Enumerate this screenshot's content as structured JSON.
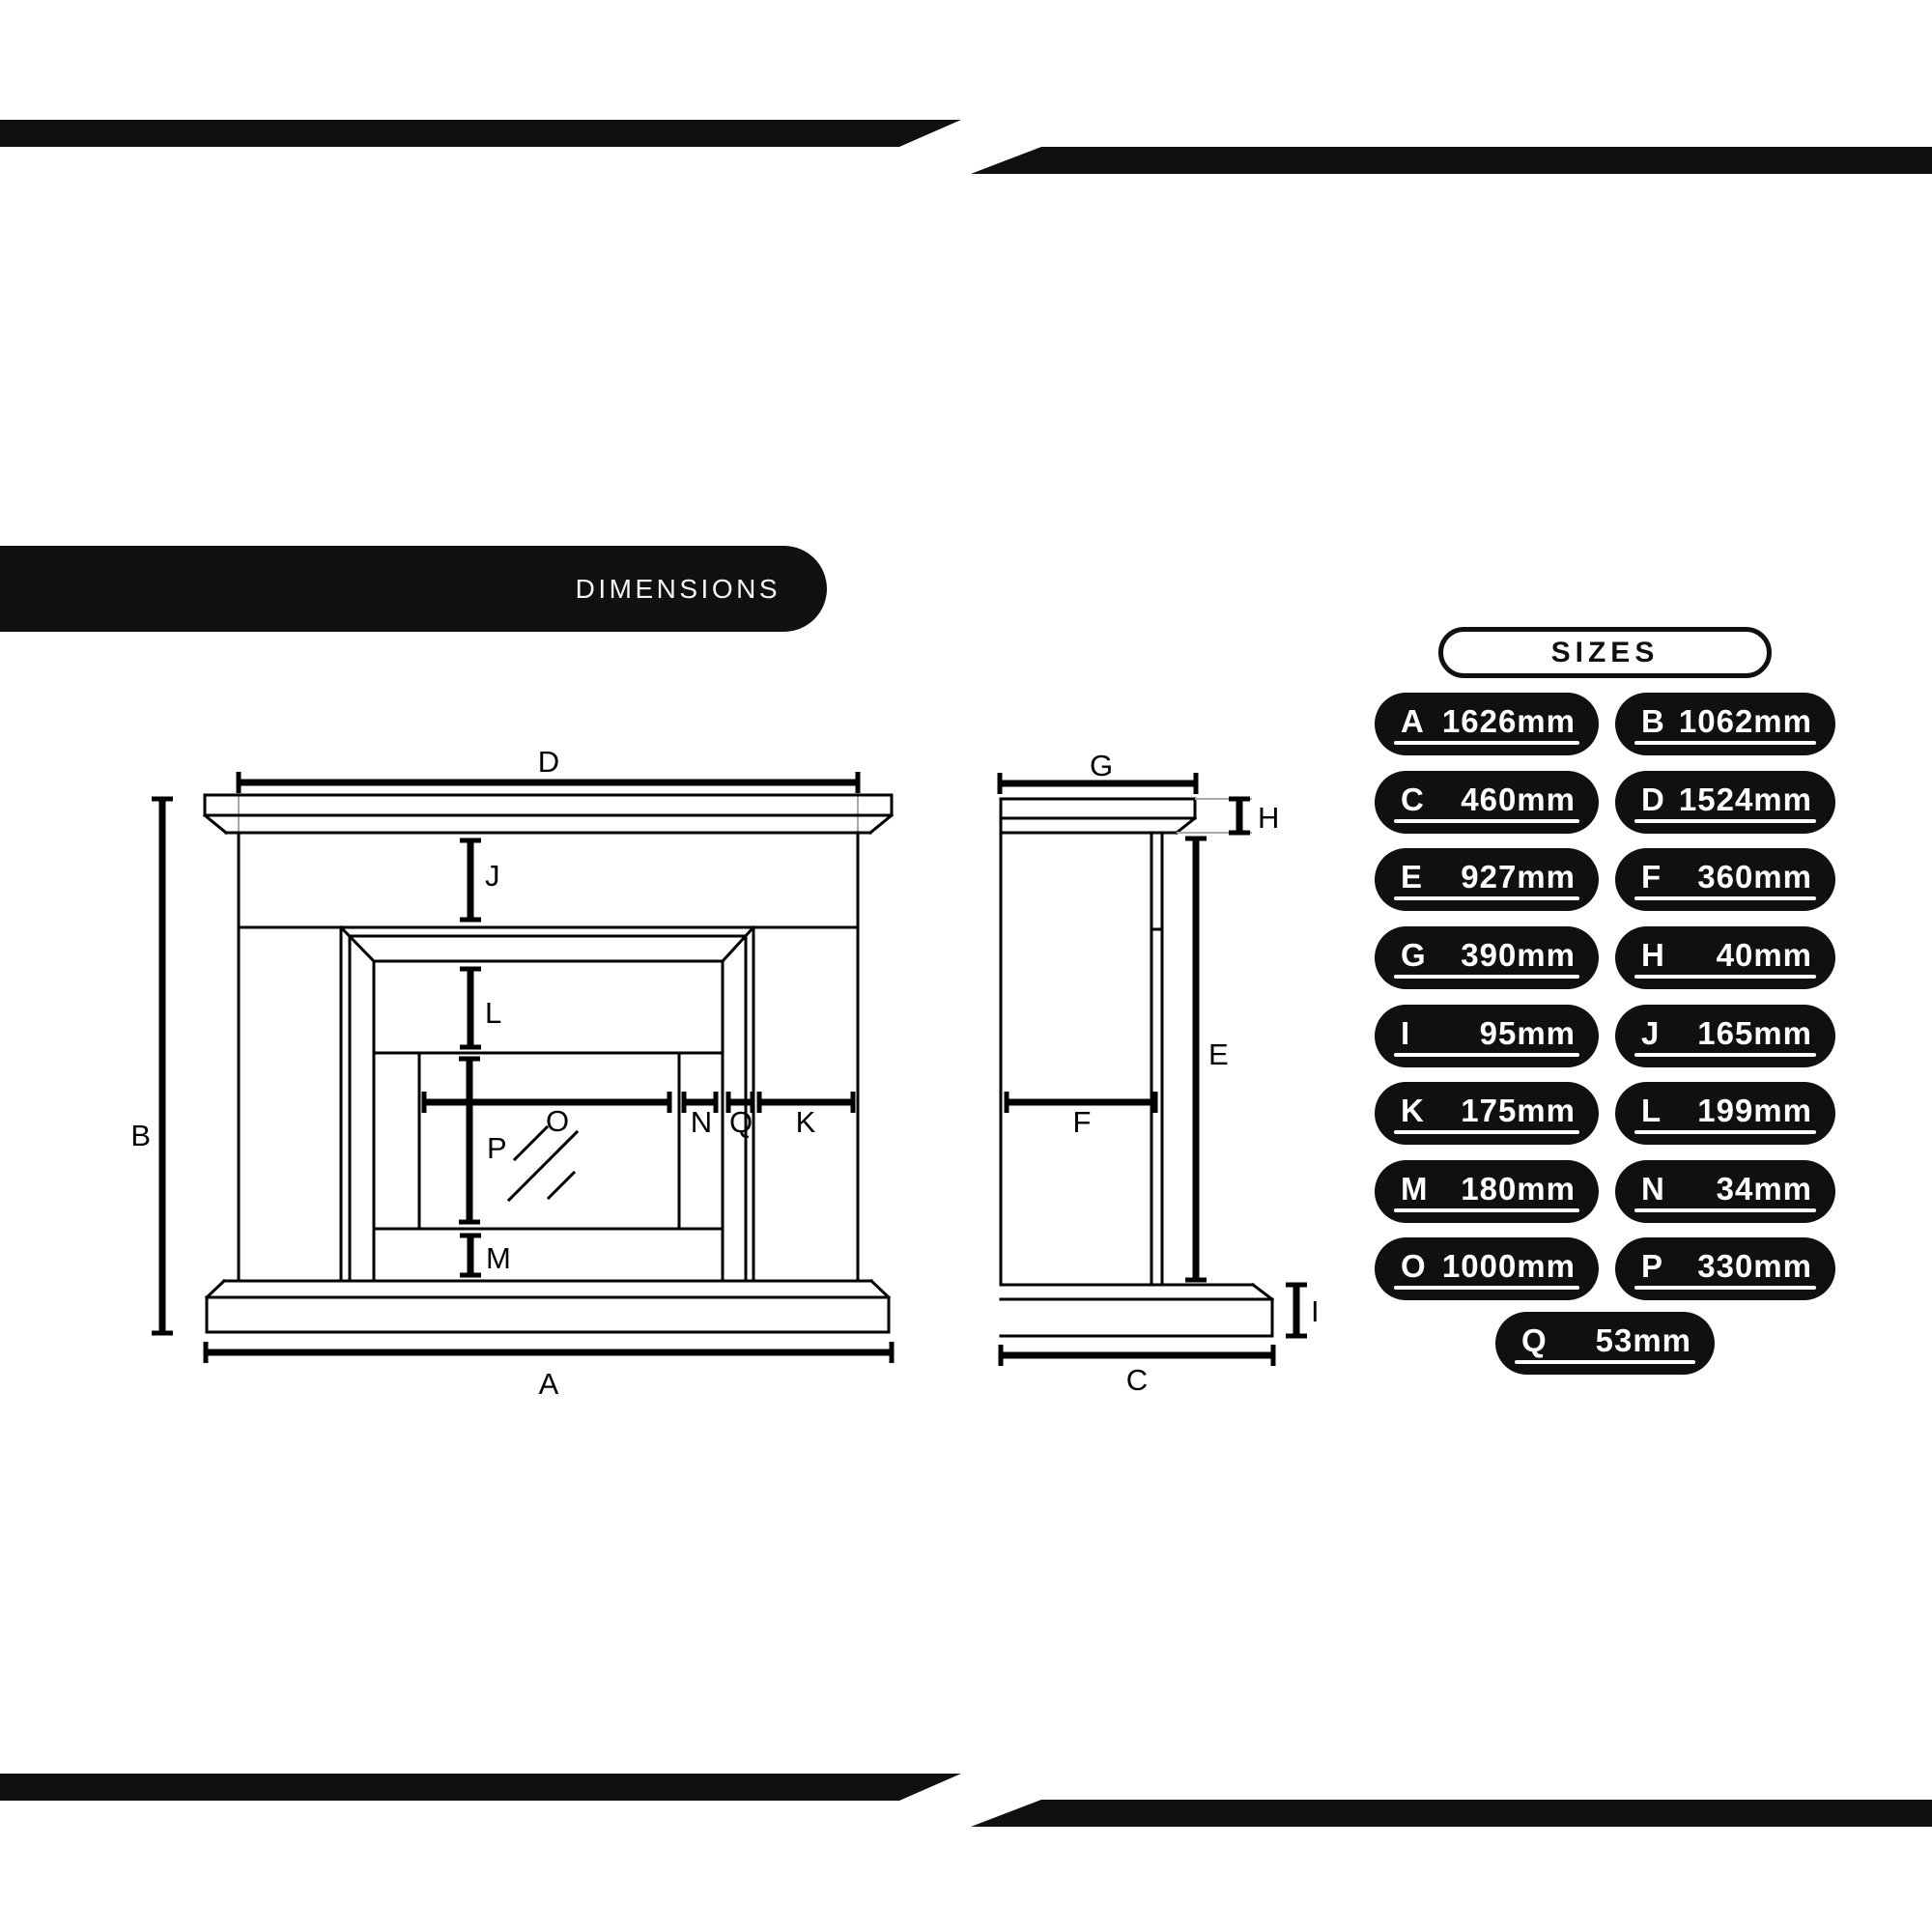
{
  "page": {
    "background": "#ffffff",
    "ink": "#101010"
  },
  "banner": {
    "label": "DIMENSIONS"
  },
  "sizes": {
    "title": "SIZES",
    "units": "mm",
    "badges": [
      {
        "letter": "A",
        "value": "1626mm"
      },
      {
        "letter": "B",
        "value": "1062mm"
      },
      {
        "letter": "C",
        "value": "460mm"
      },
      {
        "letter": "D",
        "value": "1524mm"
      },
      {
        "letter": "E",
        "value": "927mm"
      },
      {
        "letter": "F",
        "value": "360mm"
      },
      {
        "letter": "G",
        "value": "390mm"
      },
      {
        "letter": "H",
        "value": "40mm"
      },
      {
        "letter": "I",
        "value": "95mm"
      },
      {
        "letter": "J",
        "value": "165mm"
      },
      {
        "letter": "K",
        "value": "175mm"
      },
      {
        "letter": "L",
        "value": "199mm"
      },
      {
        "letter": "M",
        "value": "180mm"
      },
      {
        "letter": "N",
        "value": "34mm"
      },
      {
        "letter": "O",
        "value": "1000mm"
      },
      {
        "letter": "P",
        "value": "330mm"
      },
      {
        "letter": "Q",
        "value": "53mm"
      }
    ]
  },
  "front_view": {
    "labels": {
      "A": "A",
      "B": "B",
      "D": "D",
      "J": "J",
      "K": "K",
      "L": "L",
      "M": "M",
      "N": "N",
      "O": "O",
      "P": "P",
      "Q": "Q"
    }
  },
  "side_view": {
    "labels": {
      "C": "C",
      "E": "E",
      "F": "F",
      "G": "G",
      "H": "H",
      "I": "I"
    }
  }
}
